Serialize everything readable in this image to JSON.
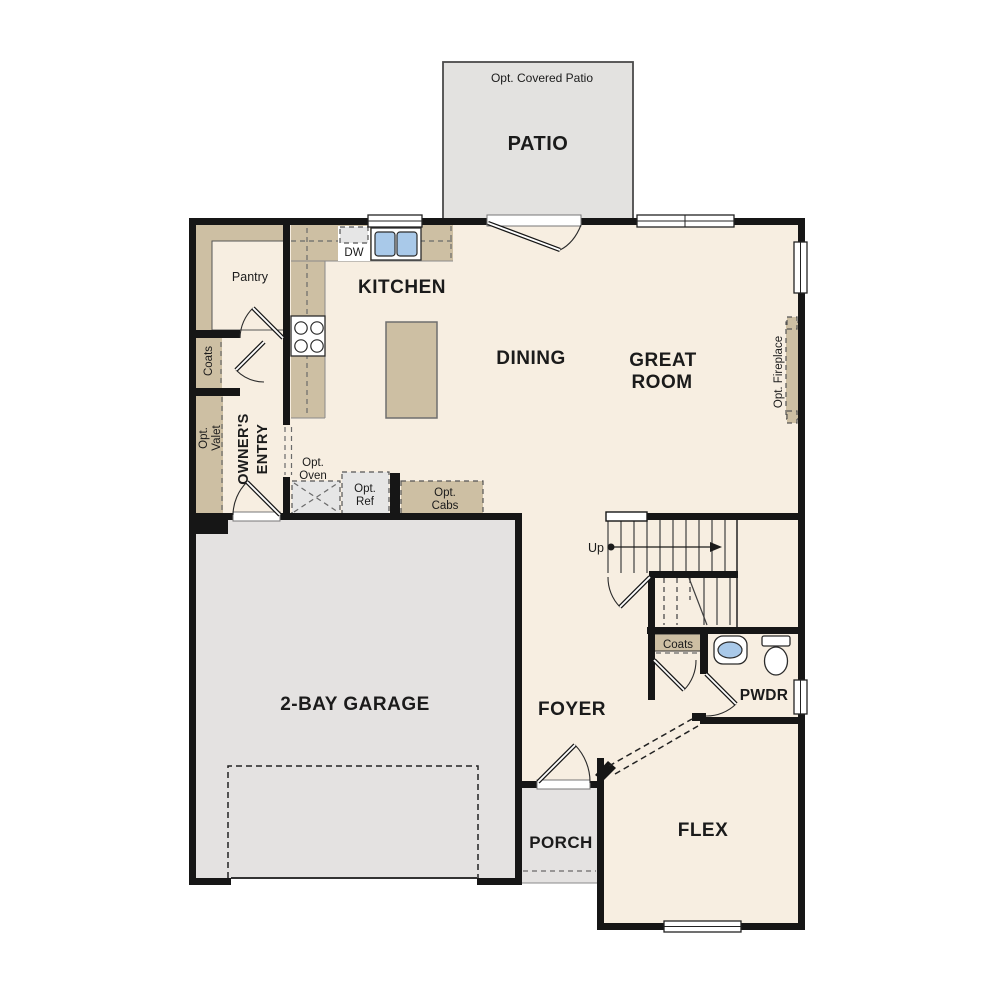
{
  "colors": {
    "wall": "#161616",
    "floor": "#f7eee1",
    "garage_floor": "#e4e2e1",
    "patio_floor": "#e3e2e0",
    "counter_tan": "#cdbfa3",
    "appliance_gray": "#e6e6e6",
    "sink_blue": "#a9c9e9"
  },
  "labels": {
    "patio_note": "Opt. Covered Patio",
    "patio": "PATIO",
    "kitchen": "KITCHEN",
    "dw": "DW",
    "pantry": "Pantry",
    "coats_left": "Coats",
    "opt_valet_1": "Opt.",
    "opt_valet_2": "Valet",
    "owners_entry_1": "OWNER'S",
    "owners_entry_2": "ENTRY",
    "dining": "DINING",
    "great_room_1": "GREAT",
    "great_room_2": "ROOM",
    "opt_fireplace": "Opt. Fireplace",
    "opt_oven_1": "Opt.",
    "opt_oven_2": "Oven",
    "opt_ref_1": "Opt.",
    "opt_ref_2": "Ref",
    "opt_cabs_1": "Opt.",
    "opt_cabs_2": "Cabs",
    "up": "Up",
    "garage": "2-BAY GARAGE",
    "foyer": "FOYER",
    "coats_stairs": "Coats",
    "pwdr": "PWDR",
    "porch": "PORCH",
    "flex": "FLEX"
  }
}
